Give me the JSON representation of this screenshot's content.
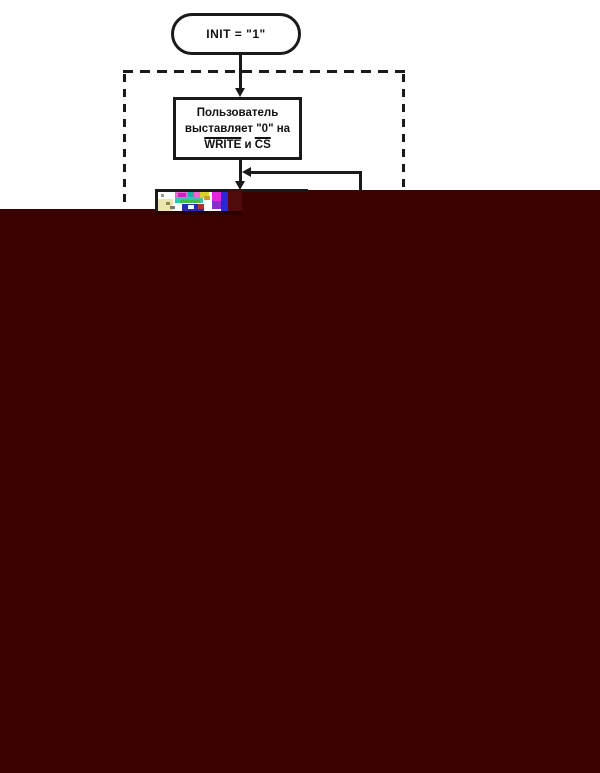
{
  "flowchart": {
    "terminator": {
      "label": "INIT = \"1\""
    },
    "process_box": {
      "line1": "Пользователь",
      "line2": "выставляет \"0\" на",
      "signal1": "WRITE",
      "conjunction": "и",
      "signal2": "CS"
    },
    "line_color": "#1a1a1a"
  },
  "corruption": {
    "overlay_color": "#3c0103",
    "lighter_patch_color": "#500a0b",
    "dark_strip_color": "#2d0000",
    "glitch_base_color": "#ffffff",
    "glitch_blocks": [
      {
        "x": 0,
        "y": 7,
        "w": 15,
        "h": 12,
        "c": "#eae6ae"
      },
      {
        "x": 3,
        "y": 2,
        "w": 3,
        "h": 3,
        "c": "#999999"
      },
      {
        "x": 8,
        "y": 10,
        "w": 4,
        "h": 3,
        "c": "#8a8a4a"
      },
      {
        "x": 12,
        "y": 14,
        "w": 5,
        "h": 3,
        "c": "#777777"
      },
      {
        "x": 17,
        "y": 0,
        "w": 25,
        "h": 6,
        "c": "#ee66d8"
      },
      {
        "x": 20,
        "y": 1,
        "w": 8,
        "h": 4,
        "c": "#cc22bb"
      },
      {
        "x": 30,
        "y": 0,
        "w": 6,
        "h": 5,
        "c": "#20b0a0"
      },
      {
        "x": 17,
        "y": 6,
        "w": 28,
        "h": 5,
        "c": "#2ec8a8"
      },
      {
        "x": 22,
        "y": 8,
        "w": 20,
        "h": 3,
        "c": "#44bb44"
      },
      {
        "x": 42,
        "y": 0,
        "w": 9,
        "h": 6,
        "c": "#d6d238"
      },
      {
        "x": 46,
        "y": 4,
        "w": 6,
        "h": 4,
        "c": "#c8a428"
      },
      {
        "x": 24,
        "y": 12,
        "w": 22,
        "h": 7,
        "c": "#2a2ab2"
      },
      {
        "x": 30,
        "y": 13,
        "w": 6,
        "h": 4,
        "c": "#ffffff"
      },
      {
        "x": 40,
        "y": 12,
        "w": 6,
        "h": 5,
        "c": "#b83030"
      },
      {
        "x": 54,
        "y": 0,
        "w": 9,
        "h": 9,
        "c": "#e428d8"
      },
      {
        "x": 54,
        "y": 9,
        "w": 9,
        "h": 8,
        "c": "#8830cc"
      },
      {
        "x": 63,
        "y": 0,
        "w": 7,
        "h": 19,
        "c": "#2828d8"
      }
    ]
  }
}
